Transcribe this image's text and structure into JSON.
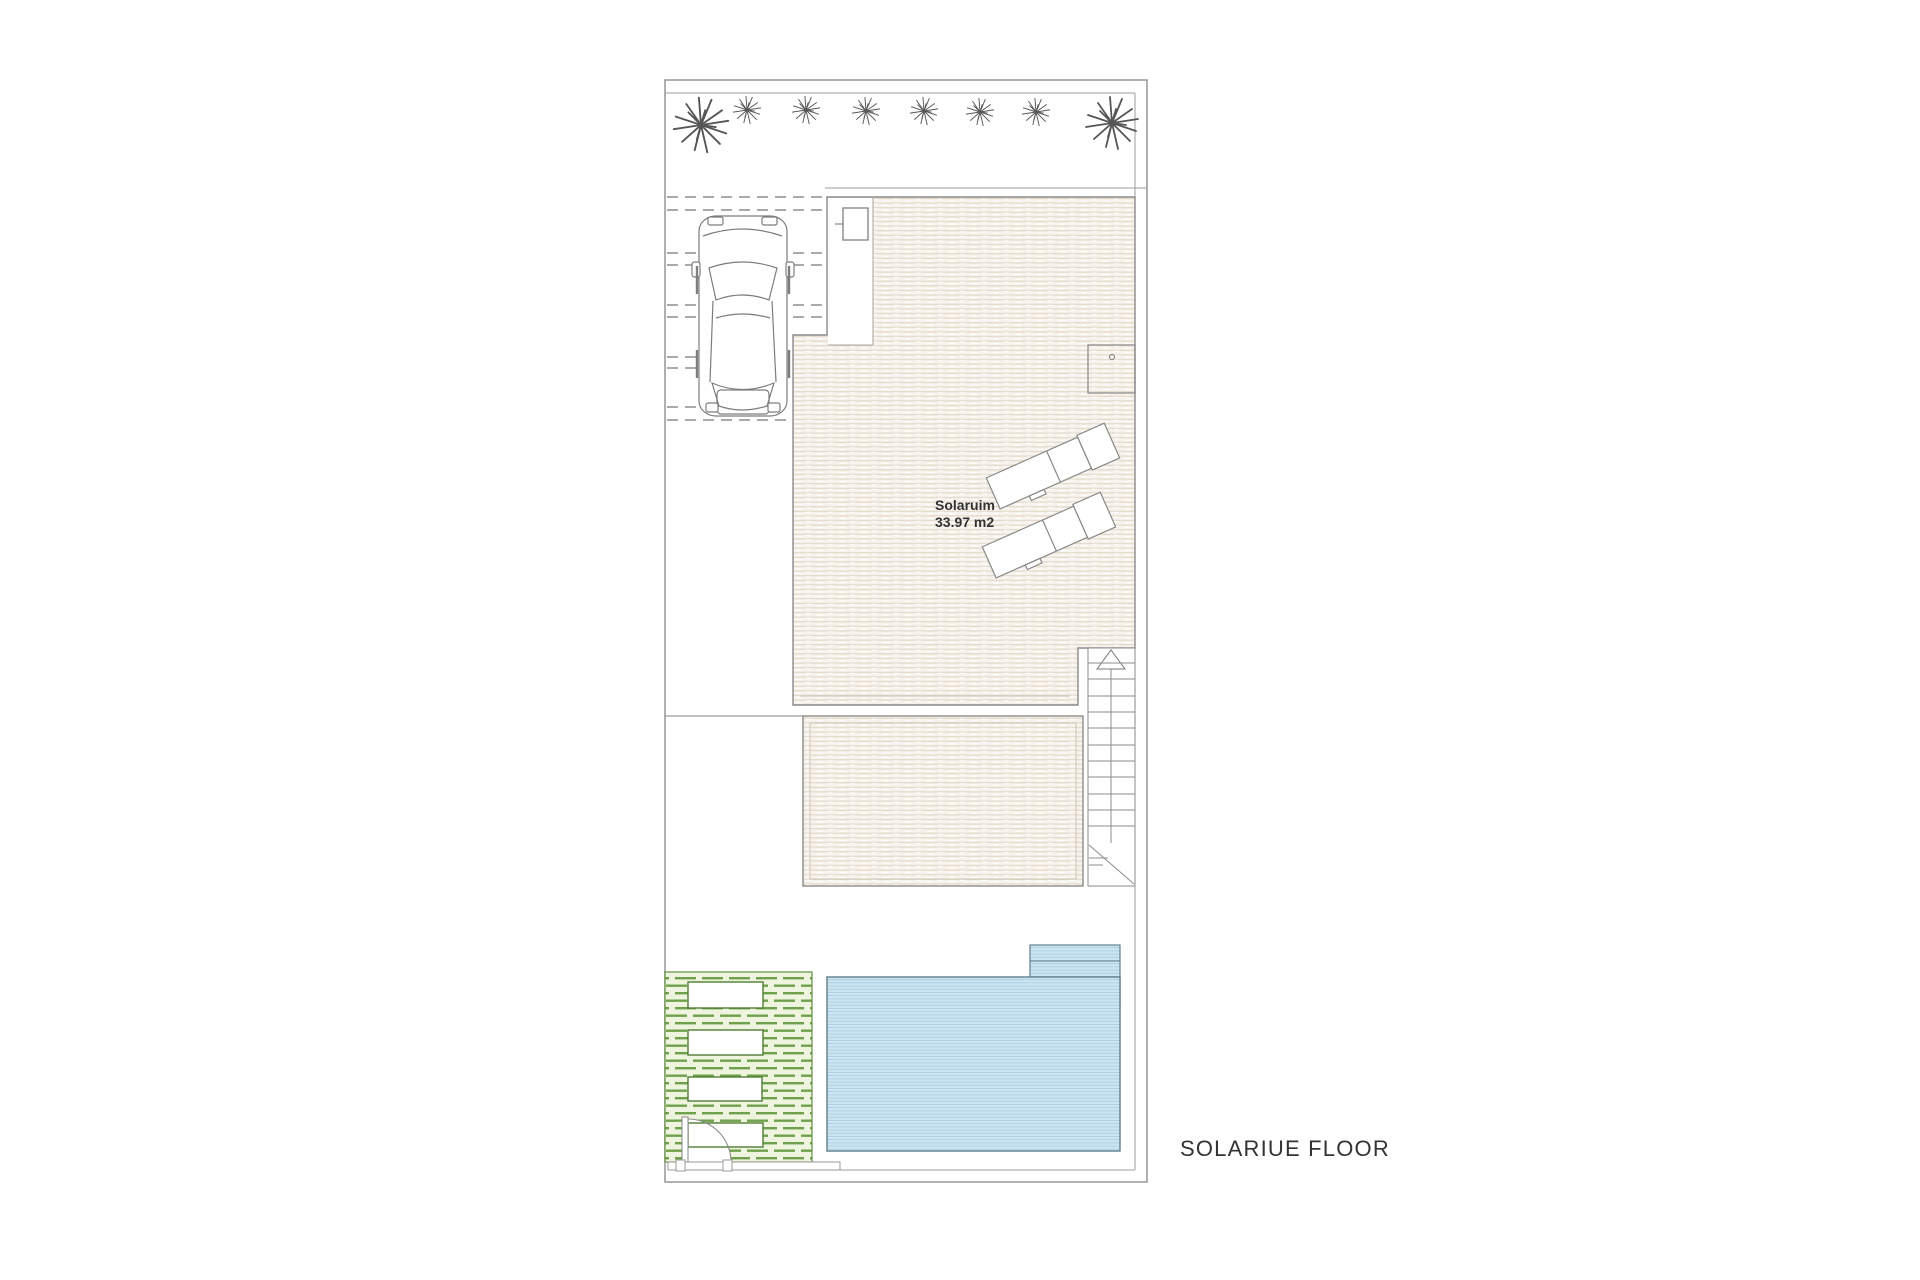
{
  "title": {
    "label": "SOLARIUE FLOOR"
  },
  "solarium": {
    "label": "Solaruim",
    "area": "33.97 m2"
  },
  "colors": {
    "boundary": "#9c9c9c",
    "wall": "#8b8b8b",
    "inner_frame": "#c9c0b2",
    "deck_base": "#f7f3ee",
    "deck_stripe": "#e7dccc",
    "pool_base": "#cde5f1",
    "pool_stripe": "#a9cee2",
    "pool_border": "#617e8c",
    "green_base": "#eef4de",
    "green_stripe": "#6fa14c",
    "green_border": "#5f8f3d",
    "plant": "#565656",
    "dash": "#777777",
    "car": "#7d7d7d",
    "text": "#333333"
  }
}
